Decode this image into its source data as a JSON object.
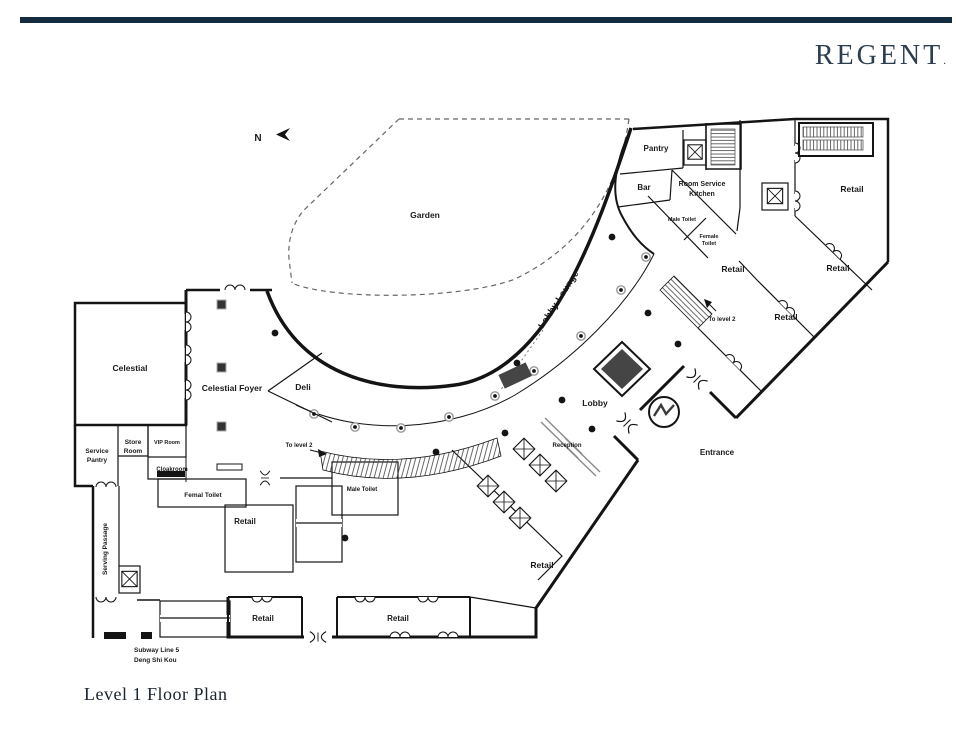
{
  "brand": {
    "name": "REGENT",
    "mark": ".",
    "bar_color": "#142c40",
    "text_color": "#2b3e50"
  },
  "page": {
    "title": "Level 1 Floor Plan"
  },
  "compass": {
    "north": "N"
  },
  "palette": {
    "wall": "#141414",
    "highlight_fill": "#b6aac8",
    "feature_fill": "#454545",
    "hatch": "#444",
    "garden_dash": "#666"
  },
  "plan": {
    "highlighted_rooms": [
      "Celestial",
      "VIP Room"
    ],
    "labels": {
      "garden": "Garden",
      "pantry": "Pantry",
      "bar": "Bar",
      "room_service_line1": "Room Service",
      "room_service_line2": "Kitchen",
      "male_toilet": "Male Toilet",
      "female_toilet_line1": "Female",
      "female_toilet_line2": "Toilet",
      "retail": "Retail",
      "to_level_2": "To level 2",
      "lobby_lounge": "Lobby Lounge",
      "celestial": "Celestial",
      "celestial_foyer": "Celestial Foyer",
      "deli": "Deli",
      "lobby": "Lobby",
      "reception": "Reception",
      "entrance": "Entrance",
      "service_pantry_line1": "Service",
      "service_pantry_line2": "Pantry",
      "store_room_line1": "Store",
      "store_room_line2": "Room",
      "vip_room": "VIP Room",
      "cloakroom": "Cloakroom",
      "femal_toilet": "Femal Toilet",
      "serving_passage": "Serving Passage",
      "subway_line1": "Subway Line 5",
      "subway_line2": "Deng Shi Kou"
    }
  }
}
